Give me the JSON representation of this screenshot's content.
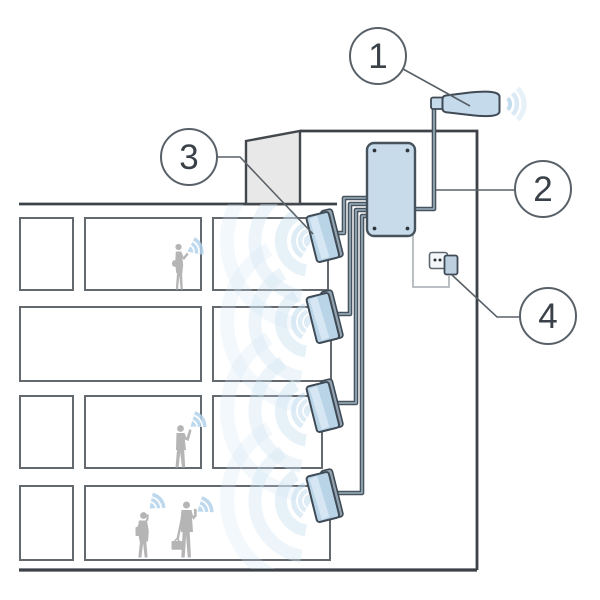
{
  "diagram": {
    "subject": "building-signal-repeater-illustration",
    "callouts": [
      {
        "label": "1",
        "component": "outdoor-antenna"
      },
      {
        "label": "2",
        "component": "antenna-feeder-cable"
      },
      {
        "label": "3",
        "component": "indoor-panel-antenna"
      },
      {
        "label": "4",
        "component": "power-outlet-plug"
      }
    ],
    "counts": {
      "floors": 4,
      "indoor_antennas": 4,
      "people": 4
    },
    "colors": {
      "device_blue": "#c7dbea",
      "panel_blue": "#b9d4e7",
      "panel_highlight": "#d9e9f4",
      "wave_blue": "#cfe4f2",
      "fan_blue": "#b3d2ea",
      "cable_dark": "#46545f",
      "outline_dark": "#3c4247",
      "roof_gray": "#e8e8e8",
      "silhouette_gray": "#b5b5b5"
    }
  }
}
